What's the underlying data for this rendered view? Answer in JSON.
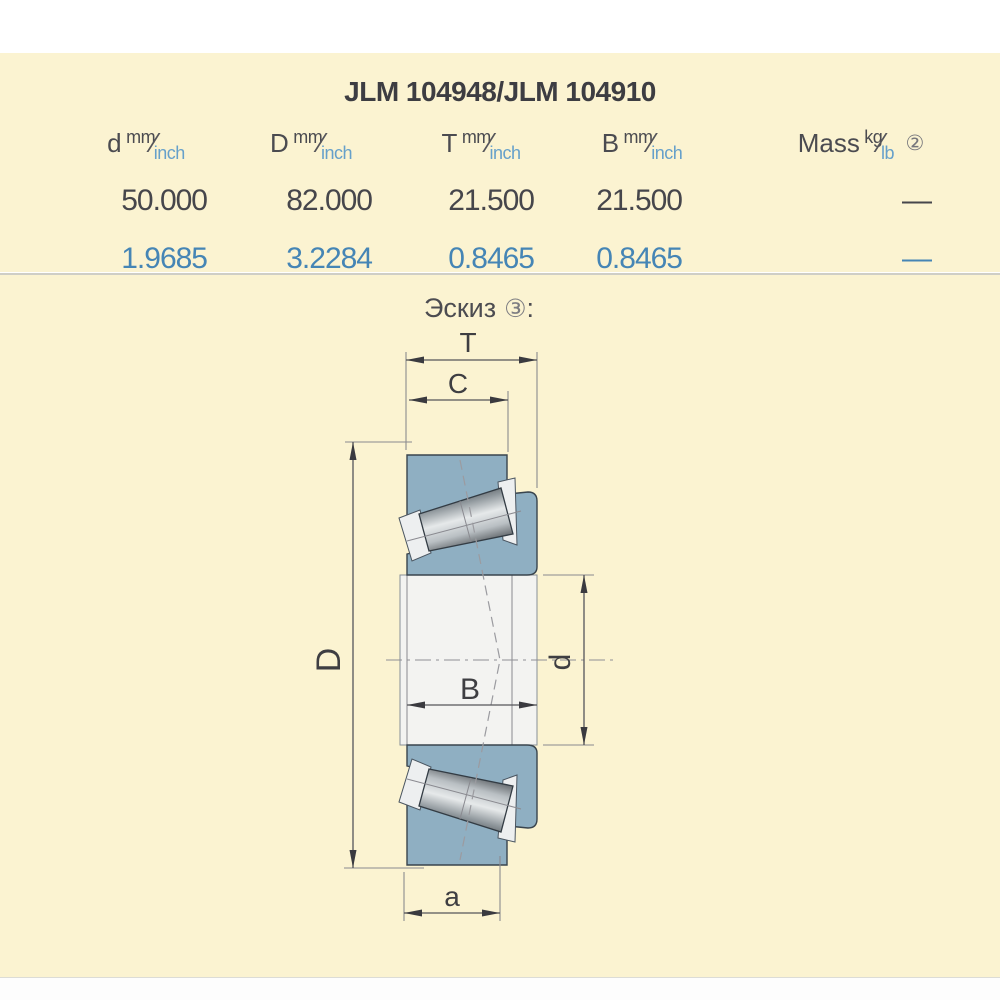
{
  "title": "JLM 104948/JLM 104910",
  "table": {
    "headers": [
      {
        "name": "d",
        "top": "mm",
        "bottom": "inch"
      },
      {
        "name": "D",
        "top": "mm",
        "bottom": "inch"
      },
      {
        "name": "T",
        "top": "mm",
        "bottom": "inch"
      },
      {
        "name": "B",
        "top": "mm",
        "bottom": "inch"
      },
      {
        "name": "Mass",
        "top": "kg",
        "bottom": "lb",
        "footnote": "②"
      }
    ],
    "row_mm": {
      "d": "50.000",
      "D": "82.000",
      "T": "21.500",
      "B": "21.500",
      "mass": "—"
    },
    "row_inch": {
      "d": "1.9685",
      "D": "3.2284",
      "T": "0.8465",
      "B": "0.8465",
      "mass": "—"
    }
  },
  "sketch": {
    "label": "Эскиз",
    "footnote": "③",
    "colon": ":",
    "dims": {
      "T": "T",
      "C": "C",
      "D": "D",
      "B": "B",
      "d": "d",
      "a": "a"
    }
  },
  "colors": {
    "panel_bg": "#fbf3d1",
    "text_dark": "#46464b",
    "text_blue": "#4585b5",
    "ring_blue": "#8fafc2",
    "separator": "#cfcec6"
  }
}
